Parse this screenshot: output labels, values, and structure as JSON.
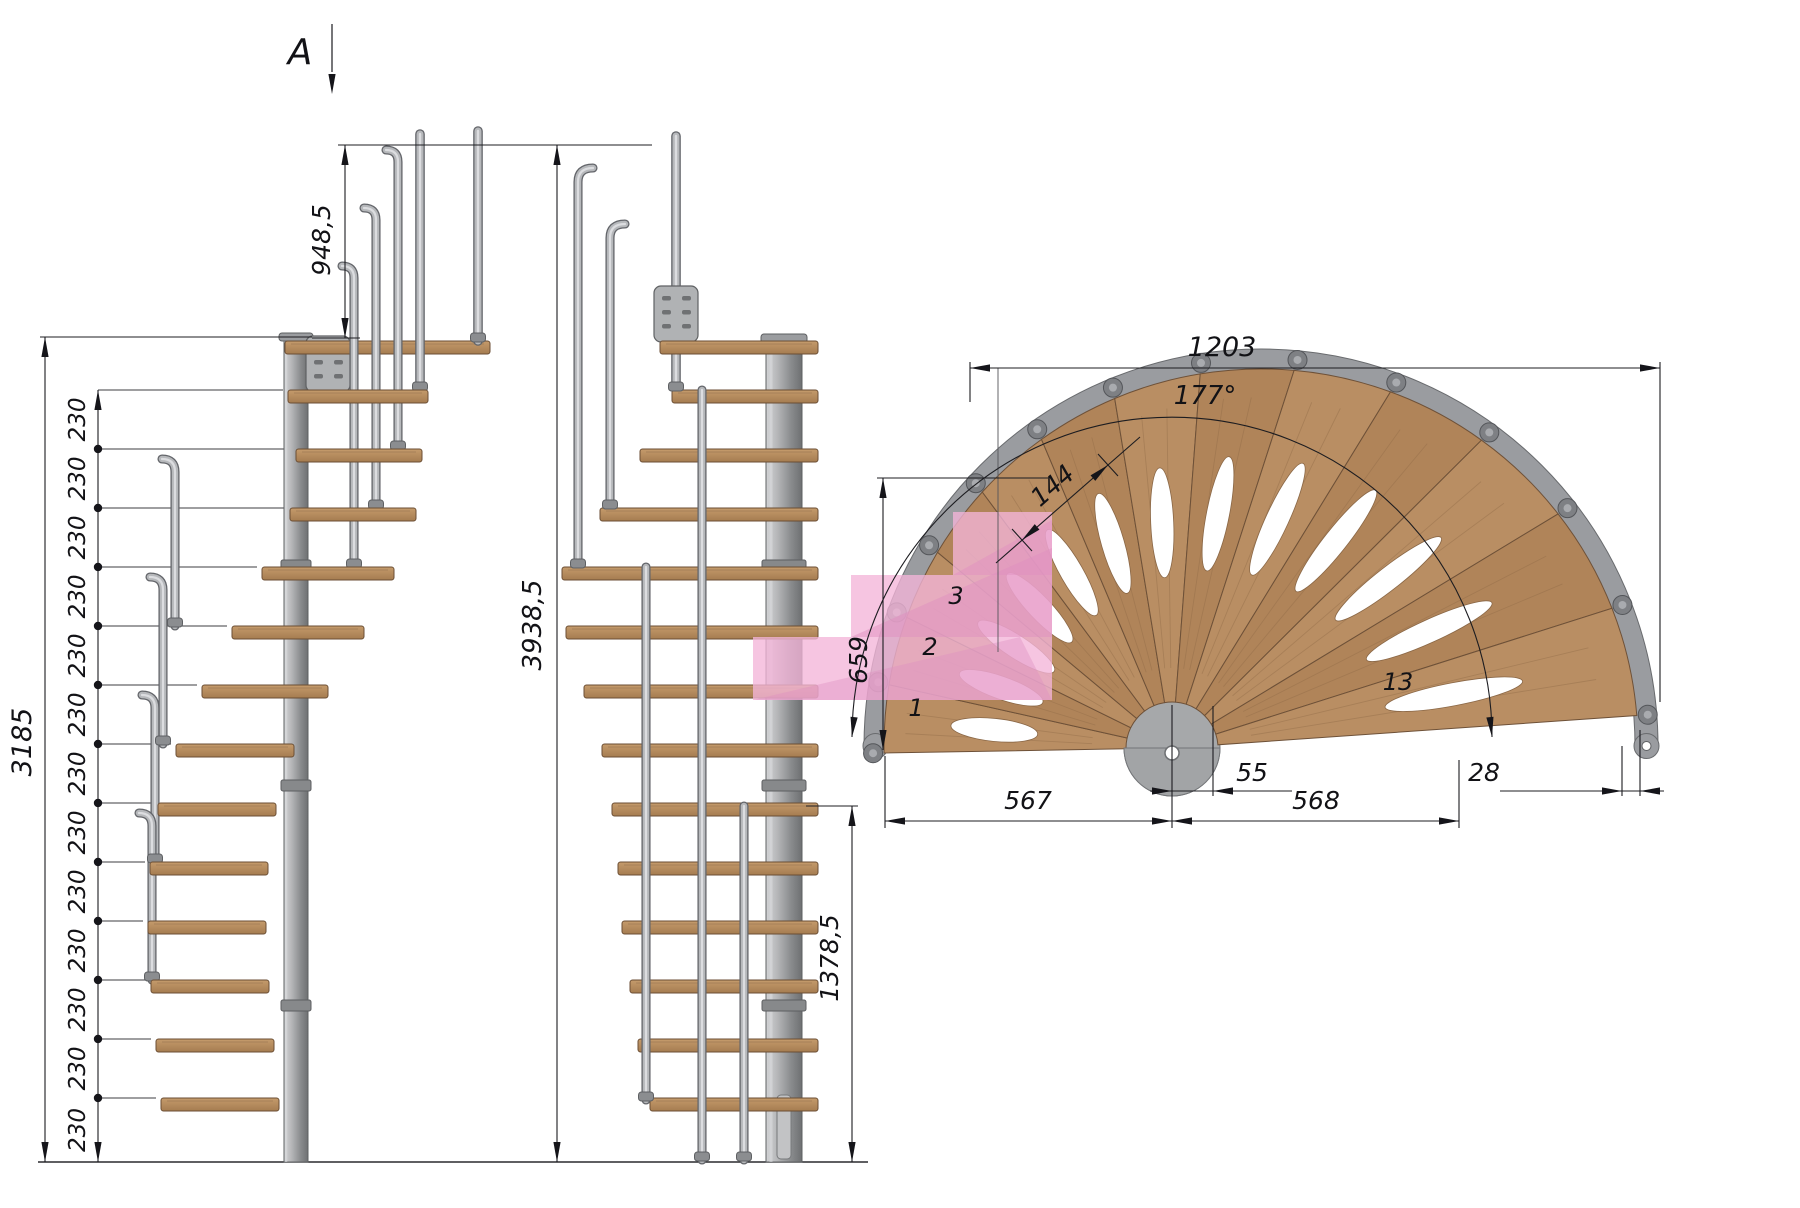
{
  "section_marker": {
    "label": "A"
  },
  "left_elevation": {
    "total_height": "3185",
    "rail_height": "948,5",
    "overall_height": "3938,5",
    "rise_labels": [
      "230",
      "230",
      "230",
      "230",
      "230",
      "230",
      "230",
      "230",
      "230",
      "230",
      "230",
      "230",
      "230"
    ]
  },
  "middle_elevation": {
    "lower_flight_height": "1378,5"
  },
  "plan_view": {
    "overall_width": "1203",
    "rotation_angle": "177°",
    "tread_nose_width": "144",
    "section_depth": "659",
    "left_span": "567",
    "right_span": "568",
    "center_offset": "55",
    "edge_offset": "28",
    "tread_count": 13,
    "tread_numbers": [
      "1",
      "2",
      "3",
      "13"
    ]
  },
  "colors": {
    "background": "#ffffff",
    "dimension_lines": "#1c1c20",
    "metal_light": "#b6b8bb",
    "metal_dark": "#63656a",
    "wood_light": "#b98e63",
    "wood_dark": "#b08459",
    "highlight_pink": "#f3b5d8",
    "highlight_pink_dark": "#df8fc0"
  }
}
